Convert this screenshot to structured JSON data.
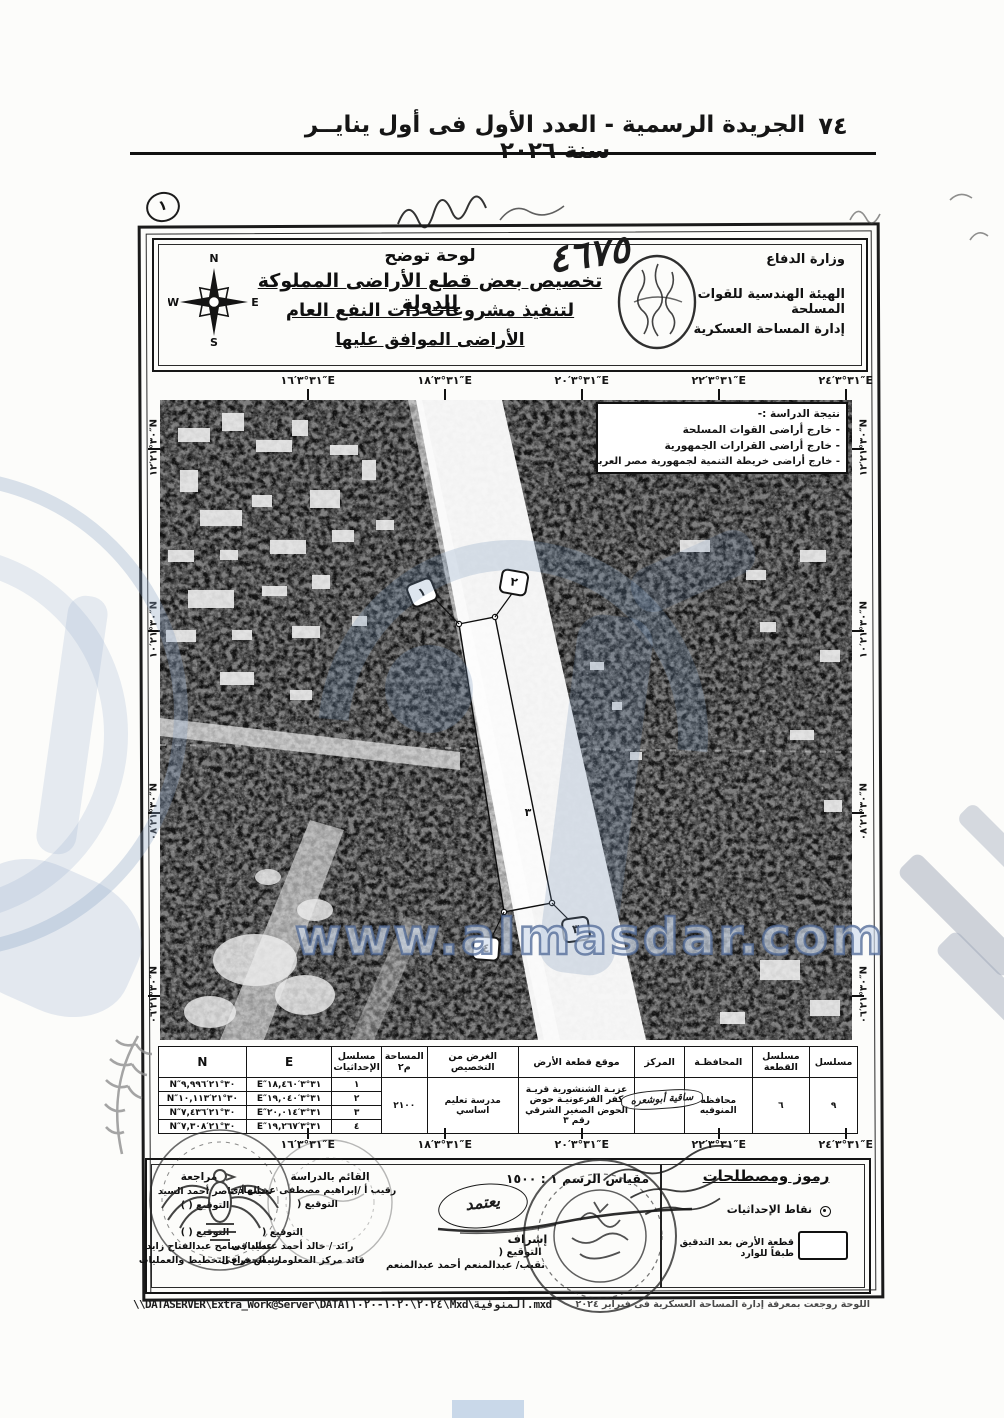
{
  "page": {
    "number": "٧٤",
    "header_title": "الجريدة الرسمية - العدد الأول فى أول ينايــر سنة ٢٠٢٦"
  },
  "title_block": {
    "line1": "لوحة توضح",
    "line2": "تخصيص بعض قطع الأراضى المملوكة للدولة",
    "line3": "لتنفيذ مشروعات ذات النفع العام",
    "line4": "الأراضى الموافق عليها",
    "ministry": "وزارة الدفاع",
    "authority": "الهيئة الهندسية للقوات المسلحة",
    "department": "إدارة المساحة العسكرية",
    "handwritten_number": "٤٦٧٥",
    "handwritten_mark": "١",
    "compass": {
      "n": "N",
      "s": "S",
      "e": "E",
      "w": "W"
    }
  },
  "study_result": {
    "title": "نتيجة الدراسة :-",
    "item1": "- خارج أراضى القوات المسلحة",
    "item2": "- خارج أراضى القرارات الجمهورية",
    "item3": "- خارج أراضى خريطة التنمية لجمهورية مصر العربية"
  },
  "coordinates": {
    "top_e": [
      "٣١°٣′١٦″E",
      "٣١°٣′١٨″E",
      "٣١°٣′٢٠″E",
      "٣١°٣′٢٢″E",
      "٣١°٣′٢٤″E"
    ],
    "side_n": [
      "٣٠°٢١′١٢″N",
      "٣٠°٢١′١٠″N",
      "٣٠°٢١′٠٨″N",
      "٣٠°٢١′٠٦″N"
    ]
  },
  "map": {
    "point_labels": [
      "١",
      "٢",
      "٣",
      "٤"
    ],
    "plot_number": "٣"
  },
  "watermark": {
    "url": "www.almasdar.com"
  },
  "table": {
    "headers": {
      "serial": "مسلسل",
      "plot_serial": "مسلسل القطعة",
      "governorate": "المحافظـة",
      "district": "المركز",
      "location": "موقع قطعة الأرض",
      "purpose": "الغرض من التخصيص",
      "area": "المساحة م٢",
      "coord_serial": "مسلسل الإحداثيات",
      "e": "E",
      "n": "N"
    },
    "row": {
      "serial": "٩",
      "plot_serial": "٦",
      "governorate": "محافظه المنوفيه",
      "district_handwritten": "ساقية أبوشعره",
      "location": "عزبـة الشنشورية قريـة كفر الفرعونيـة حوض الحوض الصغير الشرقي رقم ٣",
      "purpose": "مدرسة تعليم اساسي",
      "area": "٢١٠٠"
    },
    "coords": [
      {
        "serial": "١",
        "e": "٣١°٣′١٨,٤٦٠″E",
        "n": "٣٠°٢١′٩,٩٩٦″N"
      },
      {
        "serial": "٢",
        "e": "٣١°٣′١٩,٠٤٠″E",
        "n": "٣٠°٢١′١٠,١١٣″N"
      },
      {
        "serial": "٣",
        "e": "٣١°٣′٢٠,٠١٤″E",
        "n": "٣٠°٢١′٧,٤٣٦″N"
      },
      {
        "serial": "٤",
        "e": "٣١°٣′١٩,٢٦٧″E",
        "n": "٣٠°٢١′٧,٣٠٨″N"
      }
    ]
  },
  "legend": {
    "title": "رموز ومصطلحات",
    "coord_points": "نقاط الإحداثيات",
    "plot_after_check": "قطعة الأرض بعد التدقيق طبقاً للوارد"
  },
  "signatures": {
    "scale": "مقياس الرسم ١ : ١٥٠٠",
    "approved_handwritten": "يعتمد",
    "supervision": "إشراف",
    "signature_label": "التوقيع (",
    "signature_label_closed": "التوقيع (   )",
    "supervisor_name": "نقيب/ عبدالمنعم أحمد عبدالمنعم",
    "study_by_title": "القائم بالدراسة",
    "study_by_name": "رقيب أ /إبراهيم مصطفى عبدالهادى",
    "review_title": "مراجعة",
    "review_name": "نقيب أ/ ناصر أحمد السيد",
    "ops_name": "عميد / سامح عبدالفتاح زايد",
    "ops_title": "رئيس فرع التخطيط والعمليات",
    "gis_name": "رائد / خالد أحمد عبدالباقى",
    "gis_title": "قائد مركز المعلومات الجغرافى"
  },
  "footer": {
    "path": "\\\\DATASERVER\\Extra_Work@Server\\DATA٢٠٢٤\\١٠٢٠-١١٠٢٠\\Mxd\\المنوفية.mxd",
    "right_note": "اللوحة روجعت بمعرفة إدارة المساحة العسكرية فى فبراير ٢٠٢٤"
  }
}
